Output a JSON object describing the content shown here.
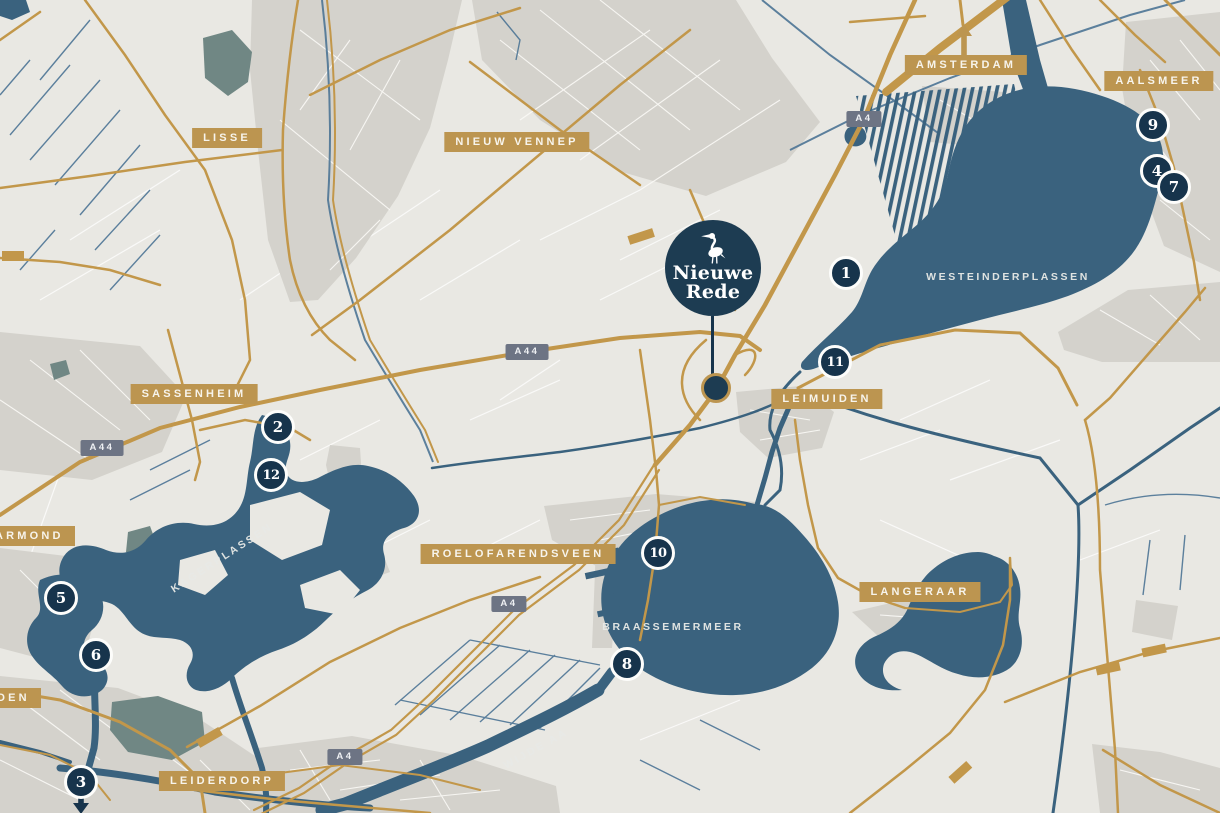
{
  "colors": {
    "background": "#e9e8e3",
    "water": "#3a627e",
    "waterway": "#4c7495",
    "road_gold": "#c2974a",
    "badge_gold": "#bc9550",
    "marker_navy": "#17344c",
    "brand_navy": "#1d3c52",
    "shield_gray": "#6d7484",
    "built_up_gray": "#d4d2cc",
    "green_area": "#708784"
  },
  "brand": {
    "icon": "heron-icon",
    "name_line1": "Nieuwe",
    "name_line2": "Rede"
  },
  "towns": {
    "lisse": "LISSE",
    "nieuw_vennep": "NIEUW VENNEP",
    "amsterdam": "AMSTERDAM",
    "aalsmeer": "AALSMEER",
    "sassenheim": "SASSENHEIM",
    "leimuiden": "LEIMUIDEN",
    "roelofarendsveen": "ROELOFARENDSVEEN",
    "langeraar": "LANGERAAR",
    "leiderdorp": "LEIDERDORP",
    "warmond_partial": "ARMOND",
    "leiden_partial": "DEN"
  },
  "waters": {
    "westeinderplassen": "WESTEINDERPLASSEN",
    "kagerplassen": "KAGERPLASSEN",
    "braassemermeer": "BRAASSEMERMEER",
    "wijde_aa": "WIJDE AA"
  },
  "shields": {
    "a4": "A4",
    "a44": "A44"
  },
  "markers": [
    "1",
    "2",
    "3",
    "4",
    "5",
    "6",
    "7",
    "8",
    "9",
    "10",
    "11",
    "12"
  ]
}
